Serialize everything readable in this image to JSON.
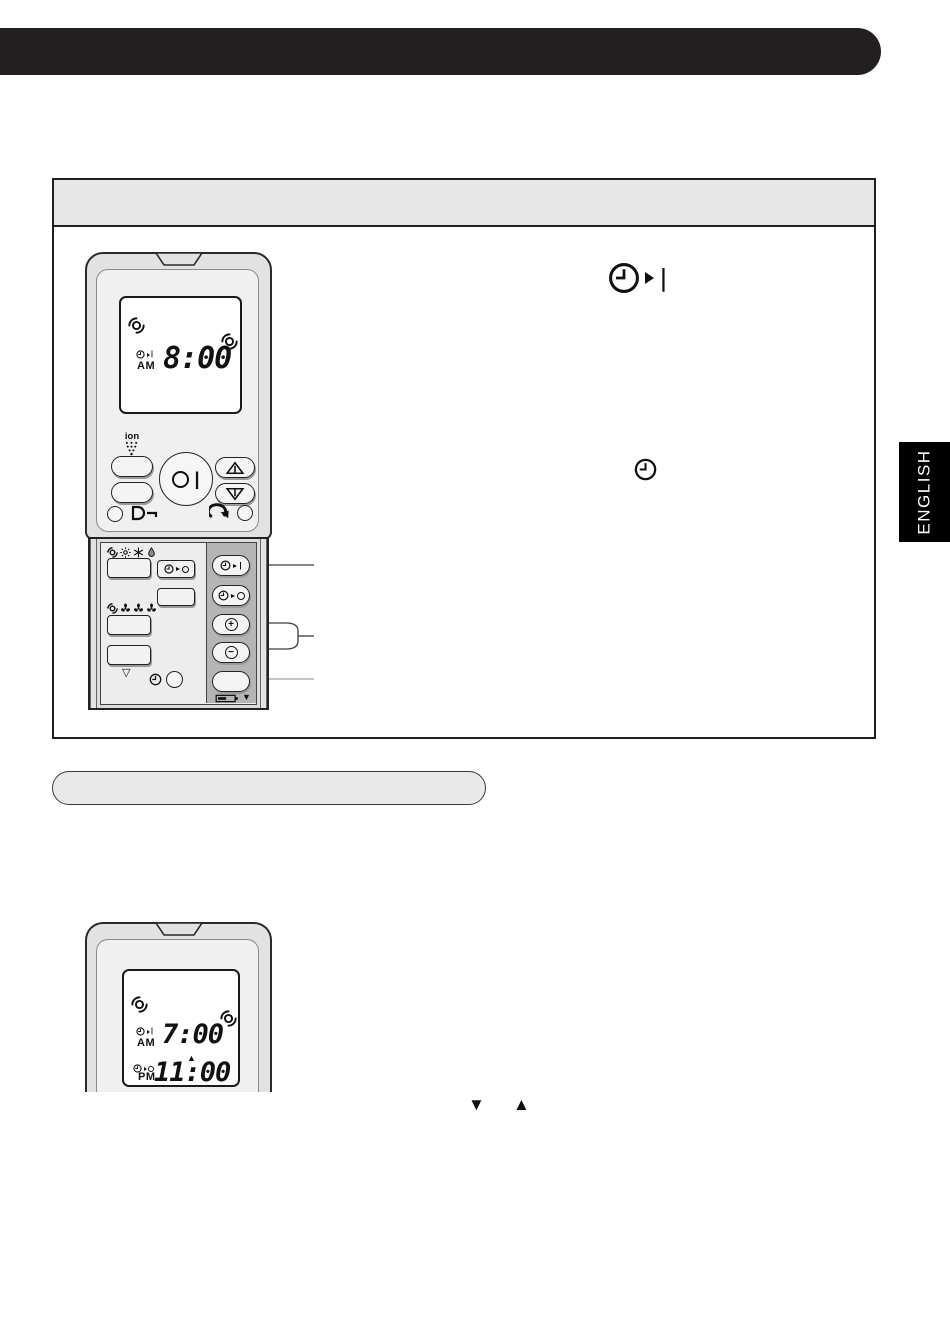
{
  "page": {
    "english_tab_label": "ENGLISH",
    "colors": {
      "header_bar": "#231f20",
      "panel_header_strip": "#e7e7e7",
      "remote_body": "#e2e2e2",
      "slide_right_column": "#b5b5b5",
      "tab_background": "#000000",
      "tab_text": "#ffffff",
      "pill_fill": "#e9e9e9"
    }
  },
  "instruction_panel": {
    "header_text": ""
  },
  "pill_header": {
    "text": ""
  },
  "remote_top": {
    "ion_label": "ion",
    "lcd": {
      "timer_on_period": "AM",
      "timer_on_time": "8:00"
    }
  },
  "remote_bottom": {
    "lcd": {
      "timer_on_period": "AM",
      "timer_on_time": "7:00",
      "cursor": "▲",
      "timer_off_period": "PM",
      "timer_off_time": "11:00"
    }
  },
  "glyphs": {
    "plus": "+",
    "minus": "−",
    "power_bar": "|",
    "timer_on_state": "|",
    "timer_off_state": "",
    "check_down": "▽",
    "battery_cursor": "▼",
    "triangle_down": "▼",
    "triangle_up": "▲"
  }
}
